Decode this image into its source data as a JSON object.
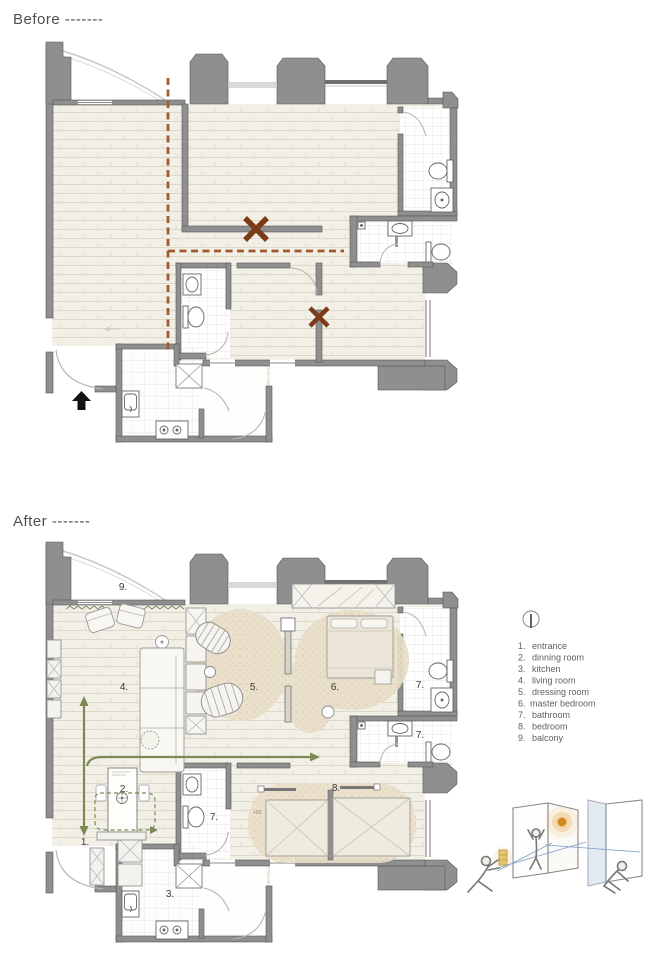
{
  "page": {
    "type": "interior-design renovation floor plans",
    "background": "#ffffff"
  },
  "sections": {
    "before": {
      "label": "Before -------"
    },
    "after": {
      "label": "After -------"
    }
  },
  "legend": {
    "items": [
      {
        "num": "1.",
        "name": "entrance"
      },
      {
        "num": "2.",
        "name": "dinning room"
      },
      {
        "num": "3.",
        "name": "kitchen"
      },
      {
        "num": "4.",
        "name": "living room"
      },
      {
        "num": "5.",
        "name": "dressing room"
      },
      {
        "num": "6.",
        "name": "master bedroom"
      },
      {
        "num": "7.",
        "name": "bathroom"
      },
      {
        "num": "8.",
        "name": "bedroom"
      },
      {
        "num": "9.",
        "name": "balcony"
      }
    ]
  },
  "after_plan": {
    "labels": {
      "balcony": "9.",
      "living": "4.",
      "dressing": "5.",
      "master": "6.",
      "bath_ensuite": "7.",
      "bath_second": "7.",
      "bath_mid": "7.",
      "dining": "2.",
      "entrance": "1.",
      "kitchen": "3.",
      "bedroom": "8.",
      "level_note": "+26"
    }
  },
  "icons": {
    "north_indicator": "circle-with-plumb-line",
    "entrance_arrow": "solid-up-arrow",
    "demolition_mark": "brown-x"
  },
  "colors": {
    "wall": "#8f8f8f",
    "wall_outline": "#555555",
    "floor_hatch": "#f1efe6",
    "demolition_line": "#a3592e",
    "demolition_x": "#7c3a17",
    "zone_tan": "#e9dfca",
    "circulation_green": "#7d8a56",
    "glow_orange": "#e8a33d",
    "sketch_blue": "#7f9fc9"
  }
}
